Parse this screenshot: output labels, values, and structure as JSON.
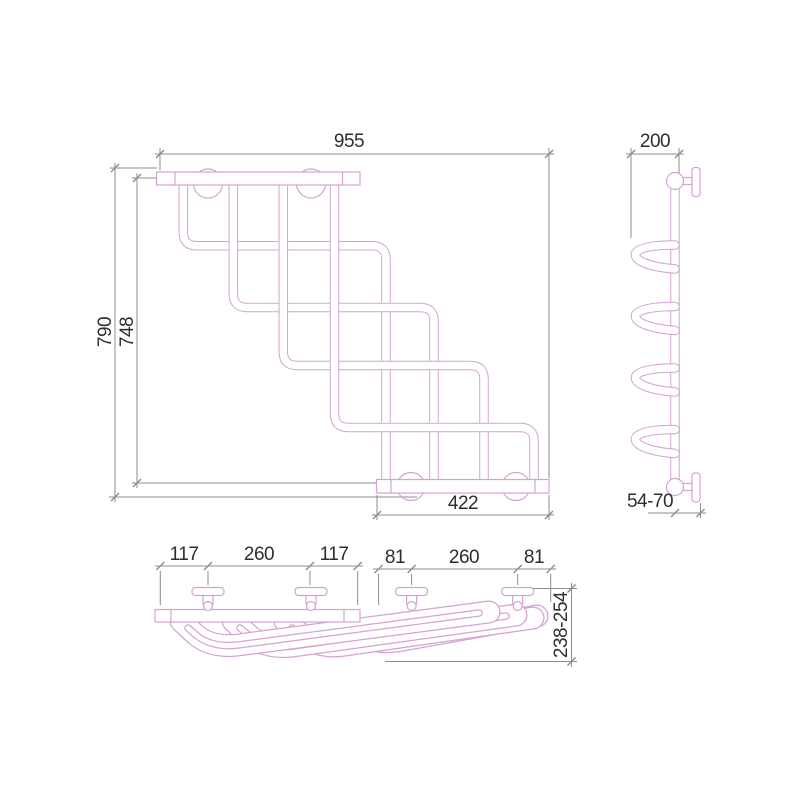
{
  "colors": {
    "product_line": "#d5a3d2",
    "dimension_line": "#8c8c8c",
    "label_text": "#2e2e2e",
    "background": "#ffffff"
  },
  "front_view": {
    "width_mm": "955",
    "height_mm": "790",
    "inner_height_mm": "748",
    "bottom_bar_width_mm": "422"
  },
  "side_view": {
    "depth_mm": "200",
    "wall_clearance_mm": "54-70"
  },
  "top_view": {
    "left_spacing_mm": [
      "117",
      "260",
      "117"
    ],
    "right_spacing_mm": [
      "81",
      "260",
      "81"
    ],
    "swing_reach_mm": "238-254"
  }
}
